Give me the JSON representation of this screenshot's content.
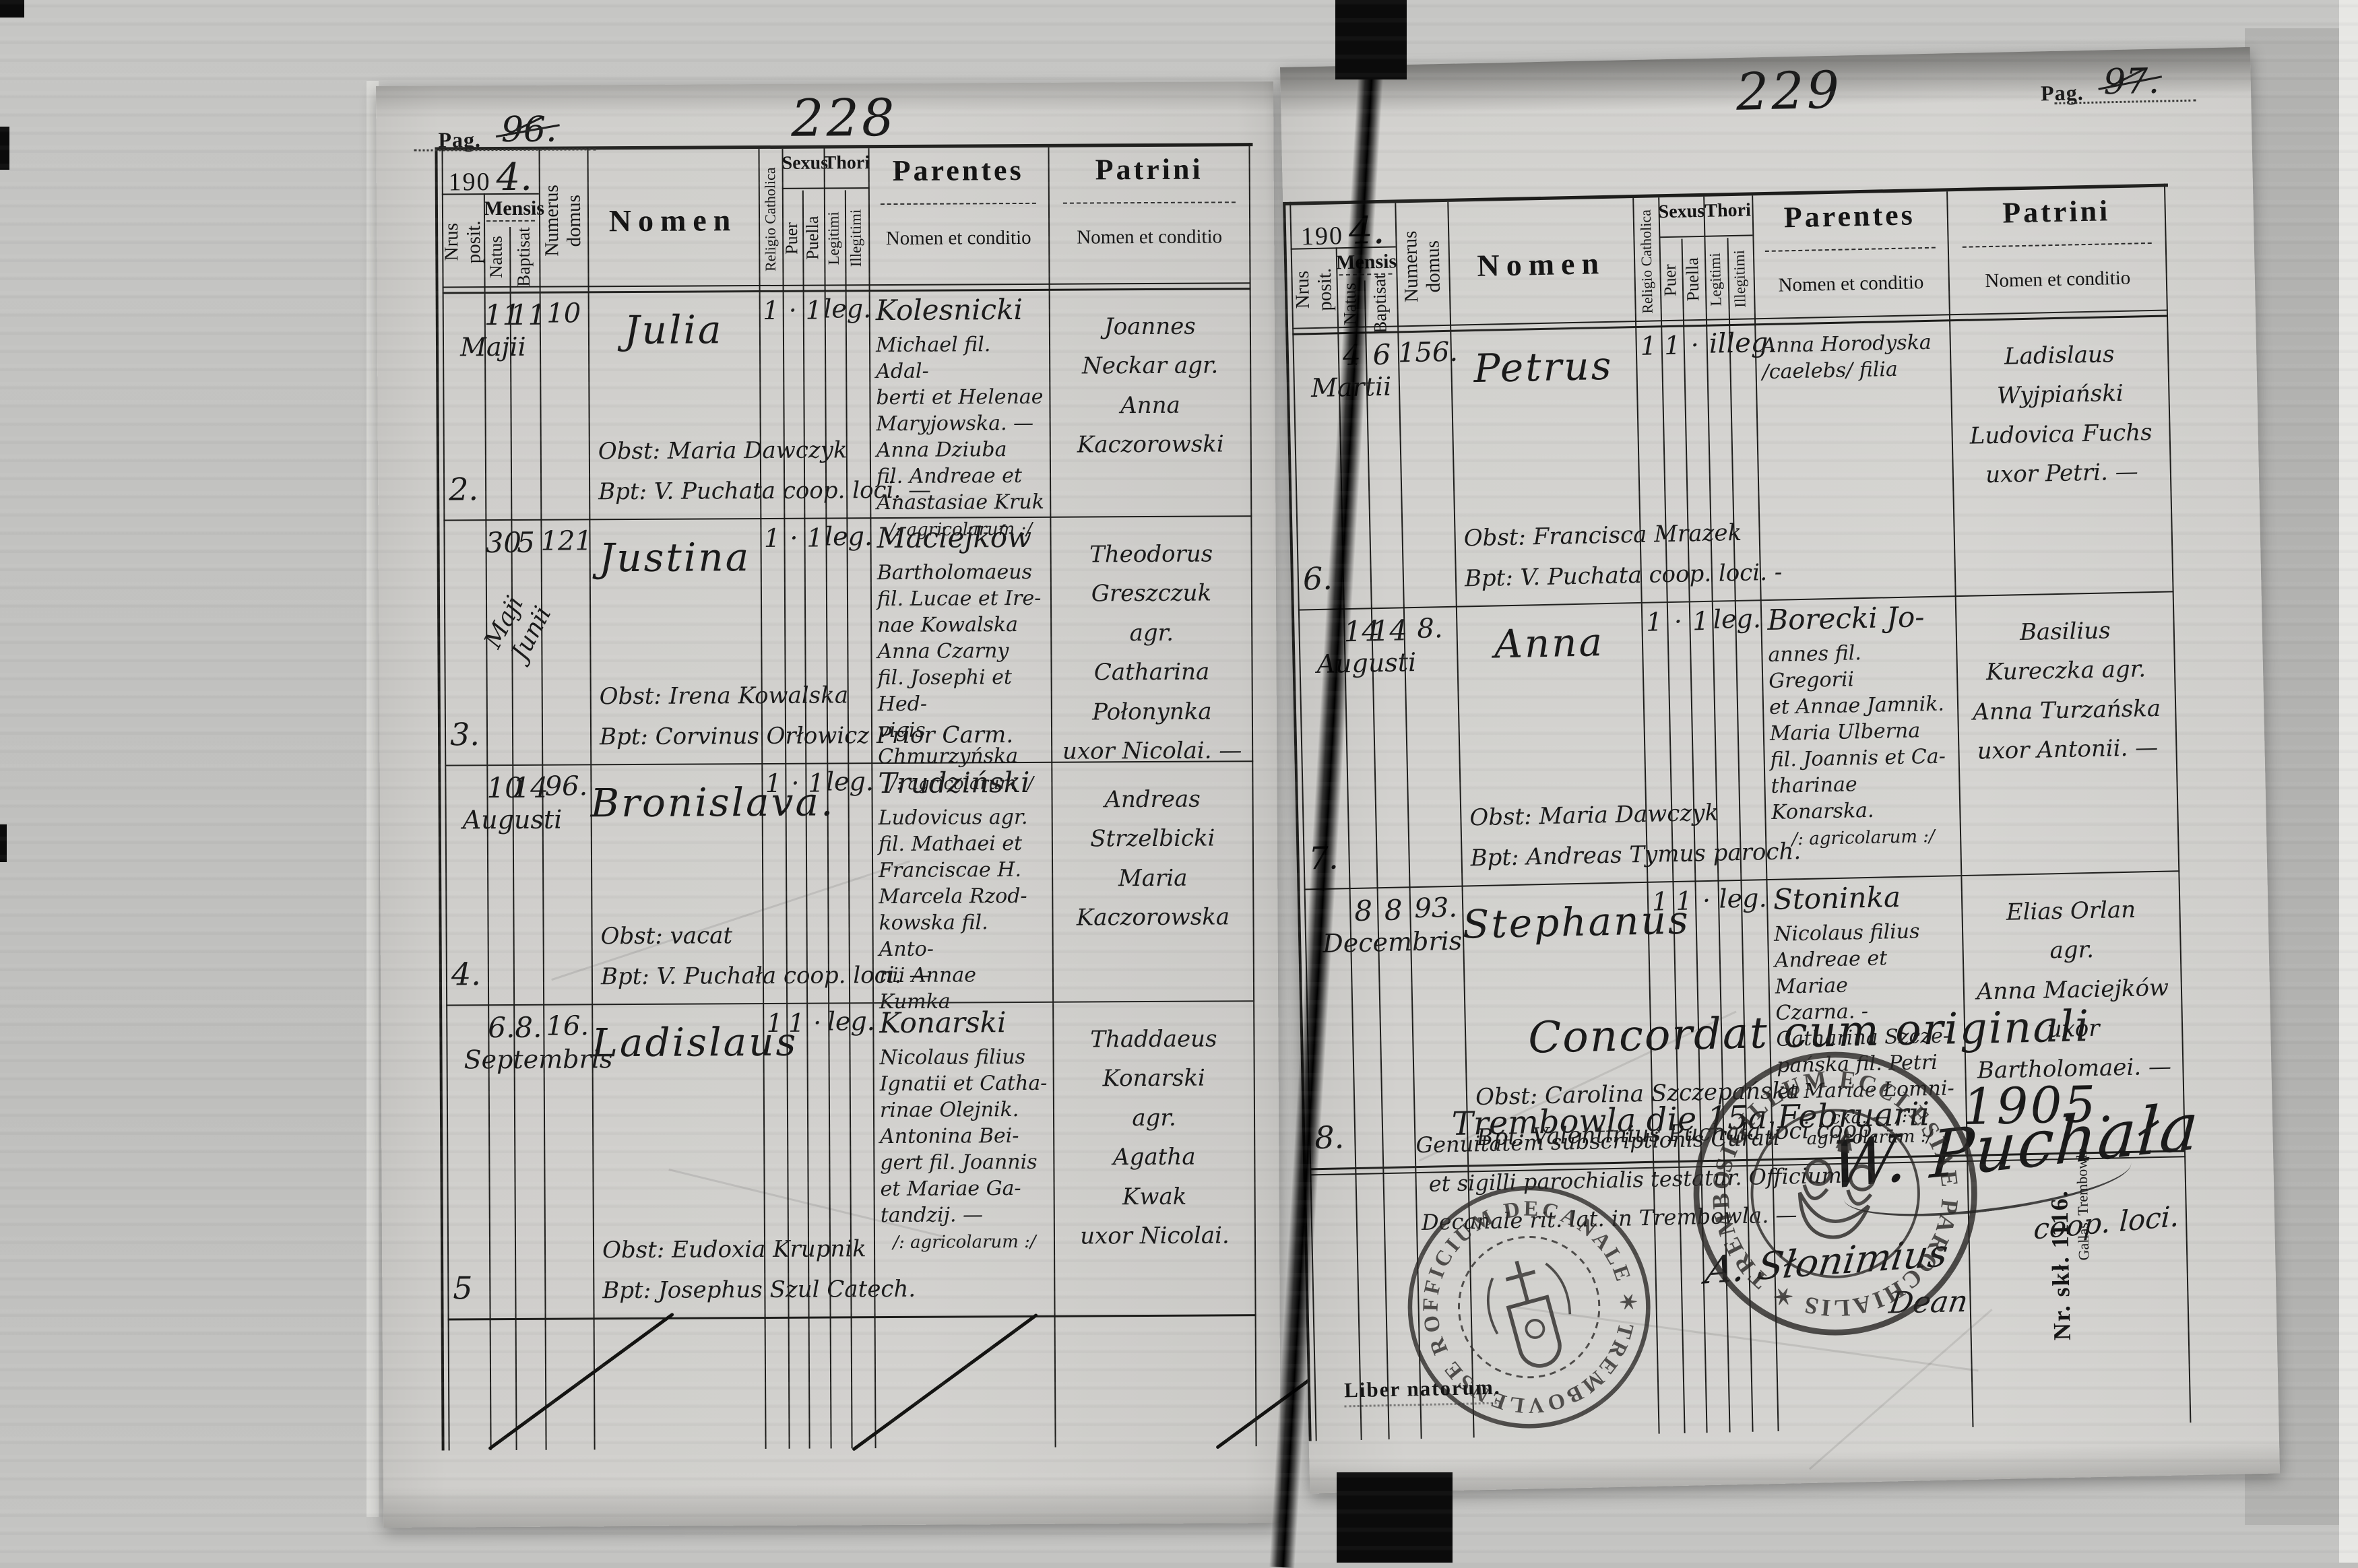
{
  "document": {
    "year_printed": "190",
    "year_handwritten": "4.",
    "book_label": "Liber natorum.",
    "margin_print_number": "Nr. skł. 1116.",
    "margin_print_publisher": "Gallas, Trembowla.",
    "column_headers": {
      "nrus": "Nrus posit.",
      "mensis": "Mensis",
      "natus": "Natus",
      "baptisat": "Baptisat",
      "domus": "Numerus domus",
      "nomen": "Nomen",
      "religio": "Religio Catholica",
      "sexus": "Sexus",
      "puer": "Puer",
      "puella": "Puella",
      "thori": "Thori",
      "legitimi": "Legitimi",
      "illegitimi": "Illegitimi",
      "parentes": "Parentes",
      "patrini": "Patrini",
      "nomen_et_conditio": "Nomen et conditio"
    },
    "pages": [
      {
        "pag_label": "Pag.",
        "old_page_number": "96.",
        "folio_number": "228",
        "rows": [
          {
            "nrus": "2.",
            "natus": "11",
            "baptisat": "11",
            "month": "Majii",
            "domus": "10",
            "nomen": "Julia",
            "obst": "Obst: Maria Dawczyk",
            "bpt": "Bpt: V. Puchata coop. loci. —",
            "religio": "1",
            "puer": "·",
            "puella": "1",
            "thori_leg": "leg.",
            "thori_illeg": "",
            "parentes": [
              "Kolesnicki",
              "Michael fil. Adal-",
              "berti et Helenae",
              "Maryjowska. —",
              "Anna Dziuba",
              "fil. Andreae et",
              "Anastasiae Kruk",
              "/: agricolarum :/"
            ],
            "patrini": [
              "Joannes",
              "Neckar  agr.",
              "Anna",
              "Kaczorowski"
            ]
          },
          {
            "nrus": "3.",
            "natus": "30",
            "baptisat": "5",
            "month": "Maji",
            "month2": "Junii",
            "domus": "121",
            "nomen": "Justina",
            "obst": "Obst: Irena Kowalska",
            "bpt": "Bpt: Corvinus Orłowicz Prior Carm.",
            "religio": "1",
            "puer": "·",
            "puella": "1",
            "thori_leg": "leg.",
            "thori_illeg": "",
            "parentes": [
              "Maciejków",
              "Bartholomaeus",
              "fil. Lucae et Ire-",
              "nae Kowalska",
              "Anna Czarny",
              "fil. Josephi et Hed-",
              "vigis Chmurzyńska",
              "/: agricolarum :/"
            ],
            "patrini": [
              "Theodorus",
              "Greszczuk",
              "agr.",
              "Catharina",
              "Połonynka",
              "uxor Nicolai. —"
            ]
          },
          {
            "nrus": "4.",
            "natus": "10",
            "baptisat": "14",
            "month": "Augusti",
            "domus": "96.",
            "nomen": "Bronislava.",
            "obst": "Obst: vacat",
            "bpt": "Bpt: V. Puchała coop. loci. —",
            "religio": "1",
            "puer": "·",
            "puella": "1",
            "thori_leg": "leg.",
            "thori_illeg": "",
            "parentes": [
              "Trudziński",
              "Ludovicus agr.",
              "fil. Mathaei et",
              "Franciscae H.",
              "Marcela Rzod-",
              "kowska fil. Anto-",
              "nii Annae Kumka"
            ],
            "patrini": [
              "Andreas",
              "Strzelbicki",
              "Maria",
              "Kaczorowska"
            ]
          },
          {
            "nrus": "5",
            "natus": "6.",
            "baptisat": "8.",
            "month": "Septembris",
            "domus": "16.",
            "nomen": "Ladislaus",
            "obst": "Obst: Eudoxia Krupnik",
            "bpt": "Bpt: Josephus Szul Catech.",
            "religio": "1",
            "puer": "1",
            "puella": "·",
            "thori_leg": "leg.",
            "thori_illeg": "",
            "parentes": [
              "Konarski",
              "Nicolaus filius",
              "Ignatii et Catha-",
              "rinae Olejnik.",
              "Antonina Bei-",
              "gert fil. Joannis",
              "et Mariae Ga-",
              "tandzij. —",
              "/: agricolarum :/"
            ],
            "patrini": [
              "Thaddaeus",
              "Konarski",
              "agr.",
              "Agatha",
              "Kwak",
              "uxor Nicolai."
            ]
          }
        ]
      },
      {
        "pag_label": "Pag.",
        "old_page_number": "97.",
        "folio_number": "229",
        "rows": [
          {
            "nrus": "6.",
            "natus": "4",
            "baptisat": "6",
            "month": "Martii",
            "domus": "156.",
            "nomen": "Petrus",
            "obst": "Obst: Francisca Mrazek",
            "bpt": "Bpt: V. Puchata coop. loci. -",
            "religio": "1",
            "puer": "1",
            "puella": "·",
            "thori_leg": "",
            "thori_illeg": "illeg.",
            "parentes": [
              "",
              "Anna Horodyska",
              "/caelebs/ filia"
            ],
            "patrini": [
              "Ladislaus",
              "Wyjpiański",
              "Ludovica Fuchs",
              "uxor Petri. —"
            ]
          },
          {
            "nrus": "7.",
            "natus": "14",
            "baptisat": "14",
            "month": "Augusti",
            "domus": "8.",
            "nomen": "Anna",
            "obst": "Obst: Maria Dawczyk",
            "bpt": "Bpt: Andreas Tymus paroch.",
            "religio": "1",
            "puer": "·",
            "puella": "1",
            "thori_leg": "leg.",
            "thori_illeg": "",
            "parentes": [
              "Borecki  Jo-",
              "annes fil. Gregorii",
              "et Annae Jamnik.",
              "Maria Ulberna",
              "fil. Joannis et Ca-",
              "tharinae Konarska.",
              "/: agricolarum :/"
            ],
            "patrini": [
              "Basilius",
              "Kureczka  agr.",
              "Anna Turzańska",
              "uxor Antonii. —"
            ]
          },
          {
            "nrus": "8.",
            "natus": "8",
            "baptisat": "8",
            "month": "Decembris",
            "domus": "93.",
            "nomen": "Stephanus",
            "obst": "Obst: Carolina Szczepańska",
            "bpt": "Bpt: Valentinius Puchała loci coop. -",
            "religio": "1",
            "puer": "1",
            "puella": "·",
            "thori_leg": "leg.",
            "thori_illeg": "",
            "parentes": [
              "Stoninka",
              "Nicolaus filius",
              "Andreae et Mariae",
              "Czarna. -",
              "Catharina Szcze-",
              "pańska fil. Petri",
              "et Mariae Łomni-",
              "cka. — /: agricolarum :/"
            ],
            "patrini": [
              "Elias Orlan",
              "agr.",
              "Anna Maciejków",
              "uxor Bartholomaei. —"
            ]
          }
        ],
        "certification": {
          "concordat_line1": "Concordat cum originali",
          "concordat_line2": "Trembowla die 15a Februarii",
          "concordat_year": "1905.",
          "attestation_lines": [
            "Genuitatem subscriptionis Curati",
            "et sigilli parochialis testatur. Officium",
            "Decanale rit. lat. in Trembowla. —"
          ],
          "dean_signature": "A. Słonimius",
          "dean_title": "Dean",
          "coop_signature": "W. Puchała",
          "coop_title": "coop. loci.",
          "stamp_decanal_text": "OFFICIUM DECANALE ✶ TREMBOVLENSE RIT. LAT. ✶",
          "stamp_parochial_text": "SIGILLUM ECCLESIAE PAROCHIALIS ✶ TREMBOVLENSIS RIT. LAT. ✶"
        }
      }
    ]
  }
}
